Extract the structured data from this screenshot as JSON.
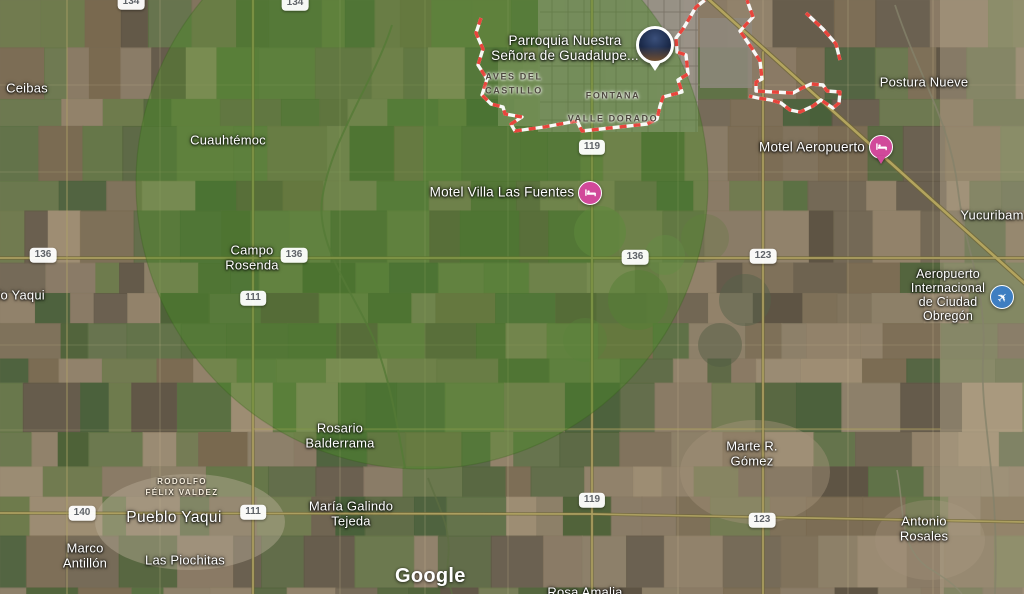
{
  "labels": {
    "ceibas": "Ceibas",
    "cuauhtemoc": "Cuauhtémoc",
    "campo_rosenda": "Campo\nRosenda",
    "rio_yaqui": "Río Yaqui",
    "rosario_balderrama": "Rosario\nBalderrama",
    "rodolfo_felix_valdez": "RODOLFO\nFÉLIX VALDEZ",
    "pueblo_yaqui": "Pueblo Yaqui",
    "marco_antillon": "Marco\nAntillón",
    "las_piochitas": "Las Piochitas",
    "maria_galindo_tejeda": "María Galindo\nTejeda",
    "rosa_amalia": "Rosa Amalia",
    "marte_r_gomez": "Marte R.\nGómez",
    "antonio_rosales": "Antonio\nRosales",
    "postura_nueve": "Postura Nueve",
    "yucuribam": "Yucuribam",
    "aves_del_castillo": "AVES DEL\nCASTILLO",
    "fontana": "FONTANA",
    "valle_dorado": "VALLE DORADO"
  },
  "pois": {
    "parroquia": "Parroquia Nuestra\nSeñora de Guadalupe...",
    "motel_villa_las_fuentes": "Motel Villa Las Fuentes",
    "motel_aeropuerto": "Motel Aeropuerto",
    "aeropuerto_obregon": "Aeropuerto\nInternacional\nde Ciudad\nObregón"
  },
  "road_shields": {
    "r134a": "134",
    "r134b": "134",
    "r119a": "119",
    "r119b": "119",
    "r136a": "136",
    "r136b": "136",
    "r136c": "136",
    "r111a": "111",
    "r111b": "111",
    "r123a": "123",
    "r123b": "123",
    "r140": "140"
  },
  "attribution": {
    "logo": "Google"
  },
  "colors": {
    "radius_overlay_green": "#4c8a28",
    "boundary_red": "#e8453c",
    "road_yellow": "#ac9f60",
    "motel_pink": "#d1499a",
    "airport_blue": "#3e7ec1",
    "label_white": "#ffffff"
  }
}
